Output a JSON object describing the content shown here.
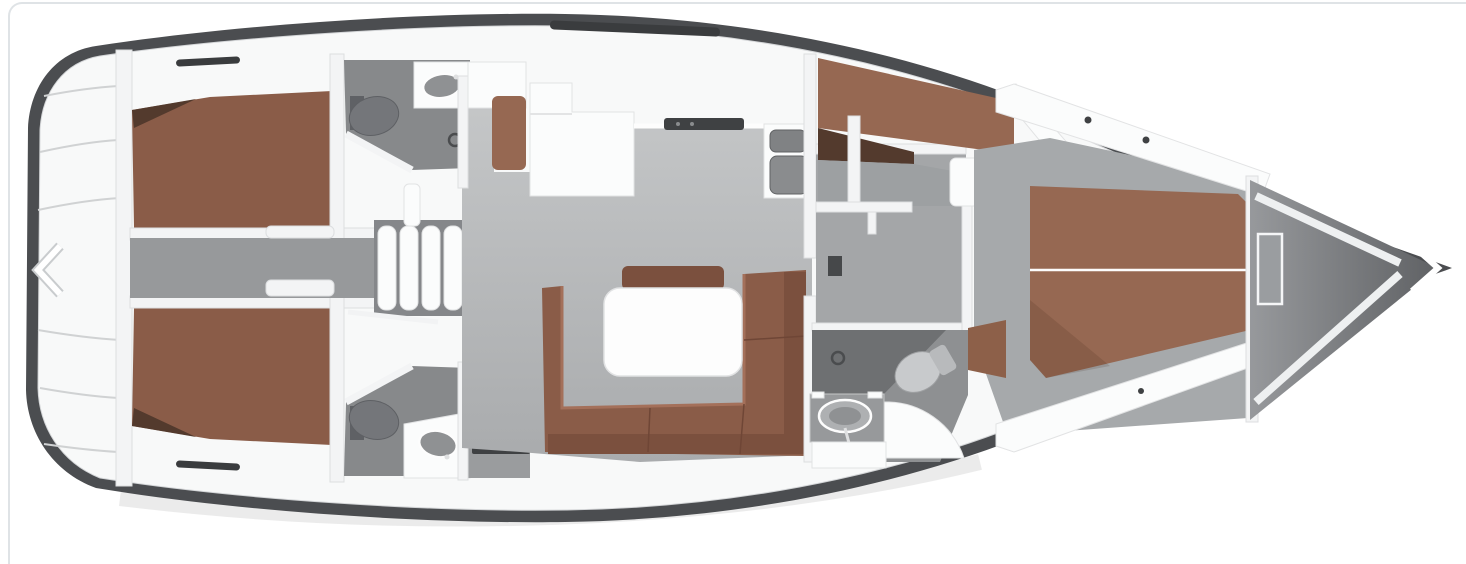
{
  "carousel": {
    "prev_icon": "chevron-left-icon",
    "next_icon": "chevron-right-icon"
  },
  "colors": {
    "page_bg": "#ffffff",
    "card_border": "#dfe3e6",
    "hull_rim": "#4b4d50",
    "deck_white": "#f8f9f9",
    "salon_floor_top": "#c6c8c9",
    "salon_floor_bottom": "#a9abad",
    "head_floor": "#87898b",
    "shower_floor": "#6e7072",
    "upholstery_brown": "#8a5c48",
    "upholstery_brown_dark": "#7b503e",
    "upholstery_brown_light": "#966852",
    "furniture_white": "#f7f8f8",
    "table_white": "#fdfdfd",
    "arrow": "#ffffff"
  },
  "diagram": {
    "type": "yacht-floorplan",
    "features": [
      "stern-swim-platform-lockers",
      "aft-port-cabin-double-berth",
      "aft-port-head-toilet-and-sink",
      "center-corridor",
      "companionway-steps",
      "chart-table-and-seat",
      "galley-counter-stove-double-sink",
      "salon-u-shaped-sofa",
      "salon-table",
      "aft-starboard-cabin-double-berth",
      "aft-starboard-head-toilet-and-sink",
      "nav-desk-compartment",
      "forward-port-cabin-berth",
      "forward-head-shower-toilet-sink",
      "owner-cabin-island-berth",
      "bow-anchor-locker"
    ]
  }
}
